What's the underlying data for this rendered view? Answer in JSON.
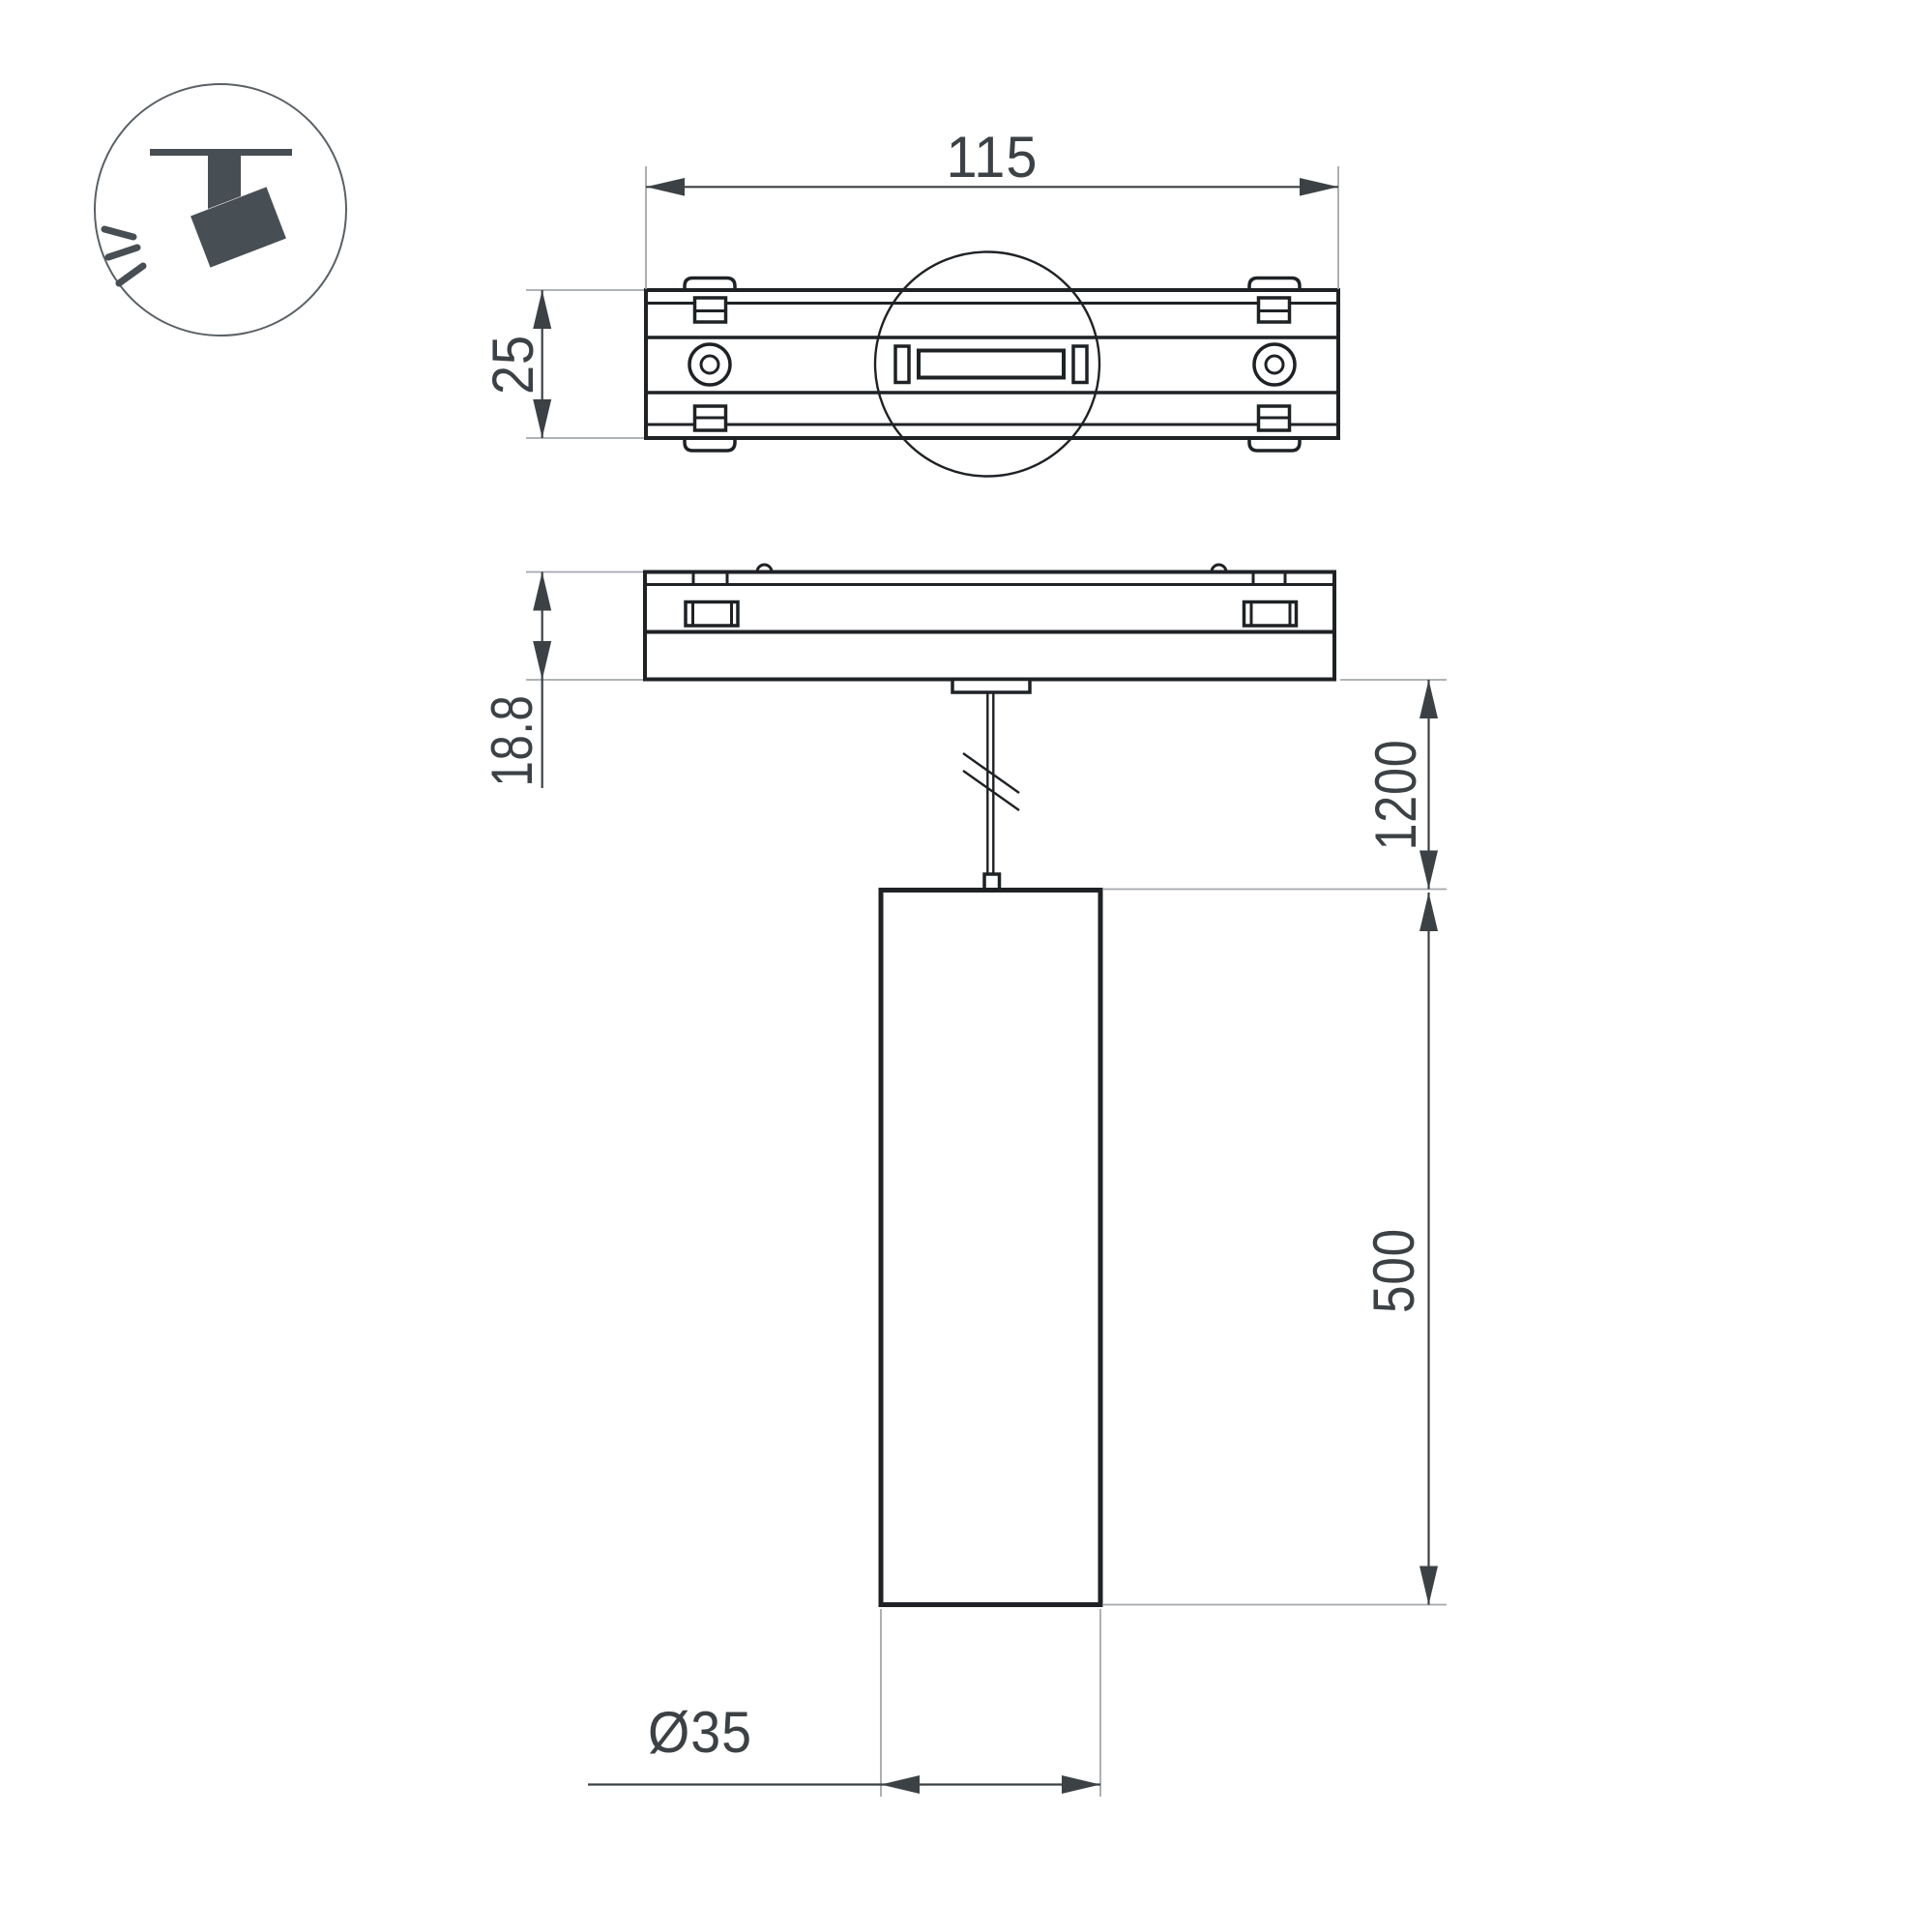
{
  "title": "Magnetic track pendant spotlight — dimension drawing",
  "icon": {
    "label": "track-spotlight"
  },
  "colors": {
    "bg": "#ffffff",
    "line": "#1f2225",
    "dim": "#3c4145",
    "ext": "#a4a8ab",
    "icon": "#474e54"
  },
  "dimensions": {
    "track_length": "115",
    "track_width": "25",
    "adapter_height": "18.8",
    "suspension_length": "1200",
    "body_height": "500",
    "body_diameter": "Ø35"
  }
}
